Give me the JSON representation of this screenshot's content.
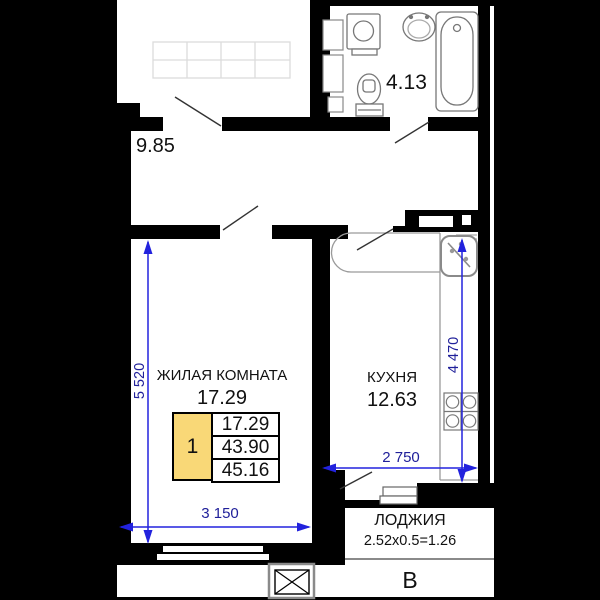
{
  "floor_plan": {
    "rooms": {
      "hallway": {
        "area": "9.85"
      },
      "bathroom": {
        "area": "4.13"
      },
      "living_room": {
        "label": "ЖИЛАЯ КОМНАТА",
        "area": "17.29"
      },
      "kitchen": {
        "label": "КУХНЯ",
        "area": "12.63"
      },
      "loggia": {
        "label": "ЛОДЖИЯ",
        "area_calc": "2.52x0.5=1.26"
      }
    },
    "apartment_table": {
      "number": "1",
      "rows": [
        "17.29",
        "43.90",
        "45.16"
      ]
    },
    "dimensions": {
      "living_room_depth": "5 520",
      "living_room_width": "3 150",
      "kitchen_width": "2 750",
      "kitchen_depth": "4 470"
    },
    "section_label": "В",
    "fixtures": [
      "wardrobe",
      "washing-machine",
      "washbasin",
      "toilet",
      "bathtub",
      "kitchen-sink",
      "stove",
      "ventilation-shaft"
    ],
    "colors": {
      "walls": "#000000",
      "dimension_lines": "#2222dd",
      "dimension_text": "#20209a",
      "table_highlight": "#f9d877"
    }
  }
}
